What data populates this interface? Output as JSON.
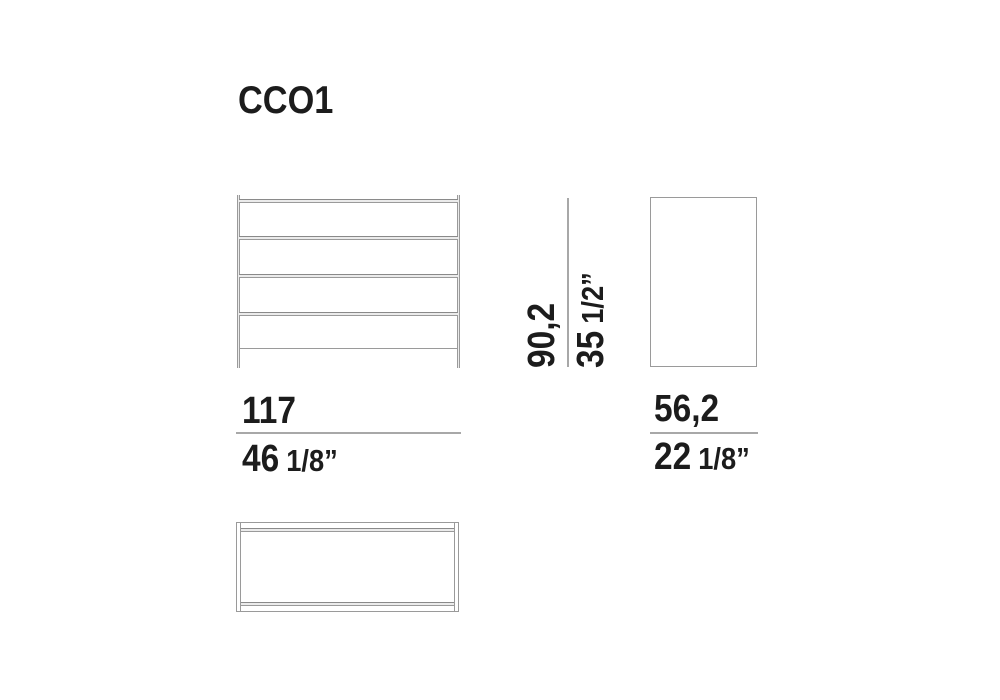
{
  "title": "CCO1",
  "dimensions": {
    "width": {
      "cm": "117",
      "inch": "46",
      "inch_fraction": "1/8”"
    },
    "height": {
      "cm": "90,2",
      "inch": "35",
      "inch_fraction": "1/2”"
    },
    "depth": {
      "cm": "56,2",
      "inch": "22",
      "inch_fraction": "1/8”"
    }
  },
  "colors": {
    "background": "#ffffff",
    "text": "#1c1c1c",
    "drawing_line": "#9a9a9a",
    "drawing_line_dark": "#8a8a8a",
    "drawing_fill": "#ebebeb",
    "dimension_line": "#a8a8a8"
  }
}
